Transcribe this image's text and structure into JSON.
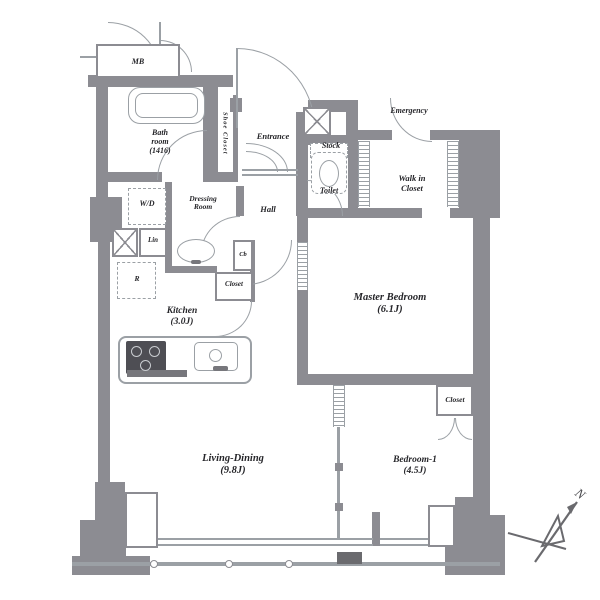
{
  "plan": {
    "mb": "MB",
    "bath": {
      "l1": "Bath",
      "l2": "room",
      "l3": "(1416)"
    },
    "shoe_closet": "Shoe Closet",
    "entrance": "Entrance",
    "emergency": "Emergency",
    "stock": "Stock",
    "toilet": "Toilet",
    "walk_in_closet": {
      "l1": "Walk in",
      "l2": "Closet"
    },
    "hall": "Hall",
    "washer_dryer": "W/D",
    "dressing": {
      "l1": "Dressing",
      "l2": "Room"
    },
    "linen": "Lin",
    "refrigerator": "R",
    "cabinet": "Cb",
    "closet_kitchen": "Closet",
    "kitchen": {
      "l1": "Kitchen",
      "l2": "(3.0J)"
    },
    "master_bedroom": {
      "l1": "Master Bedroom",
      "l2": "(6.1J)"
    },
    "closet_bedroom1": "Closet",
    "bedroom1": {
      "l1": "Bedroom-1",
      "l2": "(4.5J)"
    },
    "living_dining": {
      "l1": "Living-Dining",
      "l2": "(9.8J)"
    },
    "north": "N"
  },
  "colors": {
    "wall": "#8c8c92",
    "line": "#9ba0a5",
    "text": "#26262a",
    "background": "#ffffff"
  }
}
